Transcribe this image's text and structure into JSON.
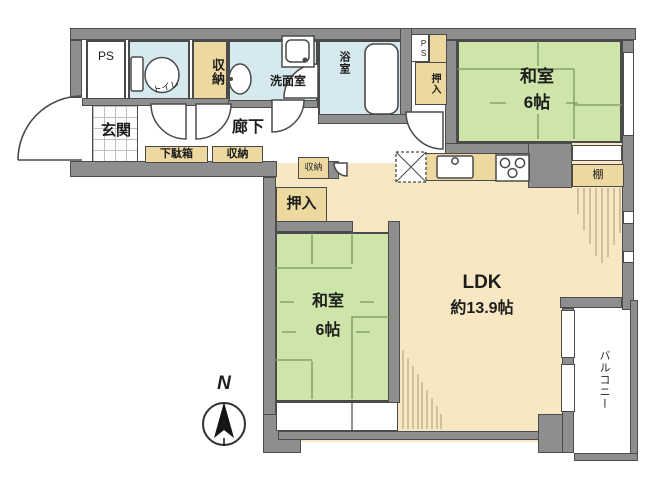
{
  "plan": {
    "title": "apartment-floor-plan",
    "labels": {
      "ps": "PS",
      "toilet": "トイレ",
      "storage_top": "収納",
      "washroom": "洗面室",
      "bath": "浴室",
      "ps_small": "PS",
      "closet_right": "押入",
      "washitsu_top": "和室",
      "washitsu_top_size": "6帖",
      "genkan": "玄関",
      "hall": "廊下",
      "shoebox": "下駄箱",
      "storage_hall": "収納",
      "storage_small": "収納",
      "closet_bottom": "押入",
      "washitsu_bottom": "和室",
      "washitsu_bottom_size": "6帖",
      "ldk": "LDK",
      "ldk_size": "約13.9帖",
      "shelf": "棚",
      "balcony": "バルコニー",
      "north": "N"
    },
    "colors": {
      "wall": "#8e8e8e",
      "tatami_room": "#cde5a9",
      "water_room": "#d6e9ee",
      "ldk_floor": "#f7e8c3",
      "closet": "#edd9a0",
      "line": "#4a4a4a"
    }
  }
}
